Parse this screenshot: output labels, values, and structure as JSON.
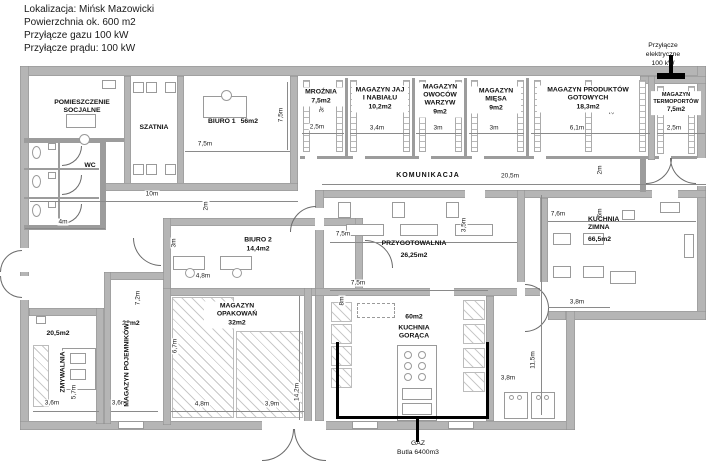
{
  "header": {
    "lines": [
      "Lokalizacja: Mińsk Mazowicki",
      "Powierzchnia ok. 600 m2",
      "Przyłącze gazu 100 kW",
      "Przyłącze prądu: 100 kW"
    ]
  },
  "annotations": {
    "electric": {
      "title": "Przyłącze elektryczne",
      "value": "100 kW"
    },
    "gas": {
      "title": "GAZ",
      "value": "Butla 6400m3"
    }
  },
  "rooms": [
    {
      "name": "POMIESZCZENIE SOCJALNE",
      "area": ""
    },
    {
      "name": "SZATNIA",
      "area": ""
    },
    {
      "name": "BIURO 1",
      "area": "56m2"
    },
    {
      "name": "WC",
      "area": ""
    },
    {
      "name": "MROŹNIA",
      "area": "7,5m2"
    },
    {
      "name": "MAGAZYN JAJ I NABIAŁU",
      "area": "10,2m2"
    },
    {
      "name": "MAGAZYN OWOCÓW WARZYW",
      "area": "9m2"
    },
    {
      "name": "MAGAZYN MIĘSA",
      "area": "9m2"
    },
    {
      "name": "MAGAZYN PRODUKTÓW GOTOWYCH",
      "area": "18,3m2"
    },
    {
      "name": "MAGAZYN TERMOPORTÓW",
      "area": "7,5m2"
    },
    {
      "name": "KOMUNIKACJA",
      "area": ""
    },
    {
      "name": "BIURO 2",
      "area": "14,4m2"
    },
    {
      "name": "MAGAZYN OPAKOWAŃ",
      "area": "32m2"
    },
    {
      "name": "PRZYGOTOWALNIA",
      "area": "26,25m2"
    },
    {
      "name": "KUCHNIA ZIMNA",
      "area": "66,5m2"
    },
    {
      "name": "KUCHNIA GORĄCA",
      "area": "60m2"
    },
    {
      "name": "ZMYWALNIA",
      "area": "20,5m2"
    },
    {
      "name": "MAGAZYN POJEMNIKÓW",
      "area": "28m2"
    }
  ],
  "dims": [
    "7,5m",
    "7,5m",
    "10m",
    "2m",
    "4m",
    "2,5m",
    "3m",
    "3,4m",
    "3m",
    "3m",
    "3m",
    "6,1m",
    "3m",
    "2,5m",
    "20,5m",
    "2m",
    "6m",
    "3m",
    "4,8m",
    "7,2m",
    "6,7m",
    "4,8m",
    "3,9m",
    "14,2m",
    "7,5m",
    "3,5m",
    "7,5m",
    "8m",
    "7,6m",
    "3,8m",
    "11,5m",
    "3,8m",
    "5,7m",
    "3,6m",
    "3,6m"
  ]
}
